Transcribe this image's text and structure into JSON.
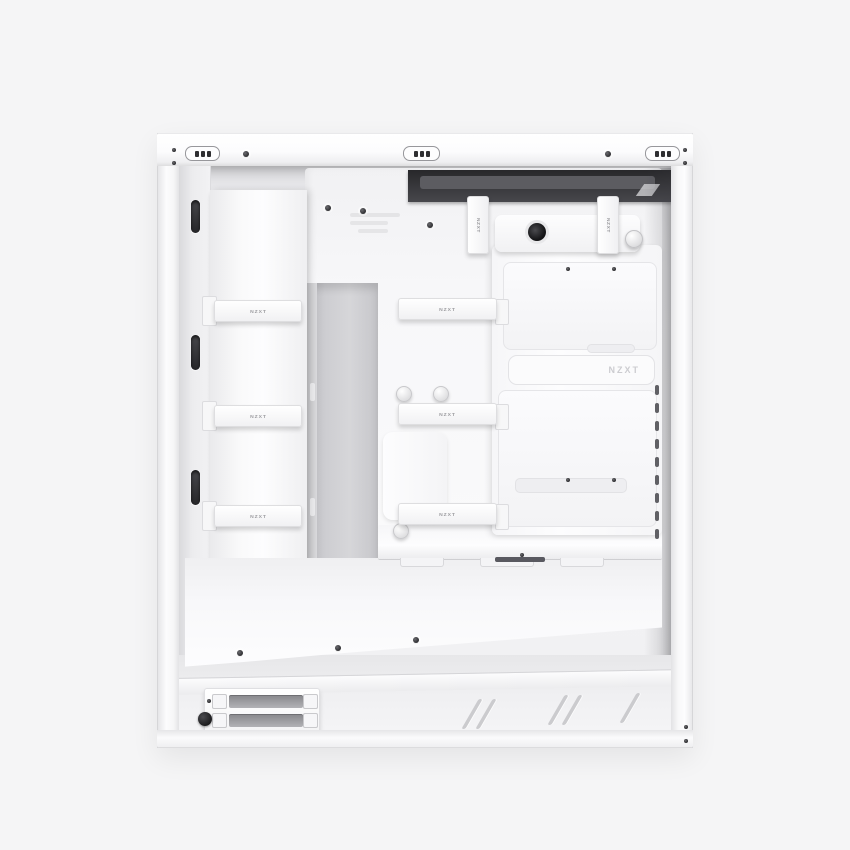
{
  "scene": {
    "description": "Product photograph of a white NZXT mid-tower PC case shown from the cable-management side with the side panel removed, centered on a plain light-gray studio background.",
    "background_color": "#f5f5f6"
  },
  "branding": {
    "strap_label": "NZXT",
    "embossed_label": "NZXT"
  },
  "colors": {
    "case_white": "#fbfbfc",
    "interior_gray": "#eeeef0",
    "panel_shadow": "#e3e3e6",
    "top_dark_band": "#3a3a3e",
    "slot_dark": "#2e2e31",
    "strap_text": "#9b9b9f",
    "embossed_text": "#ccccd0",
    "channel_gray": "#c9c9cd"
  }
}
